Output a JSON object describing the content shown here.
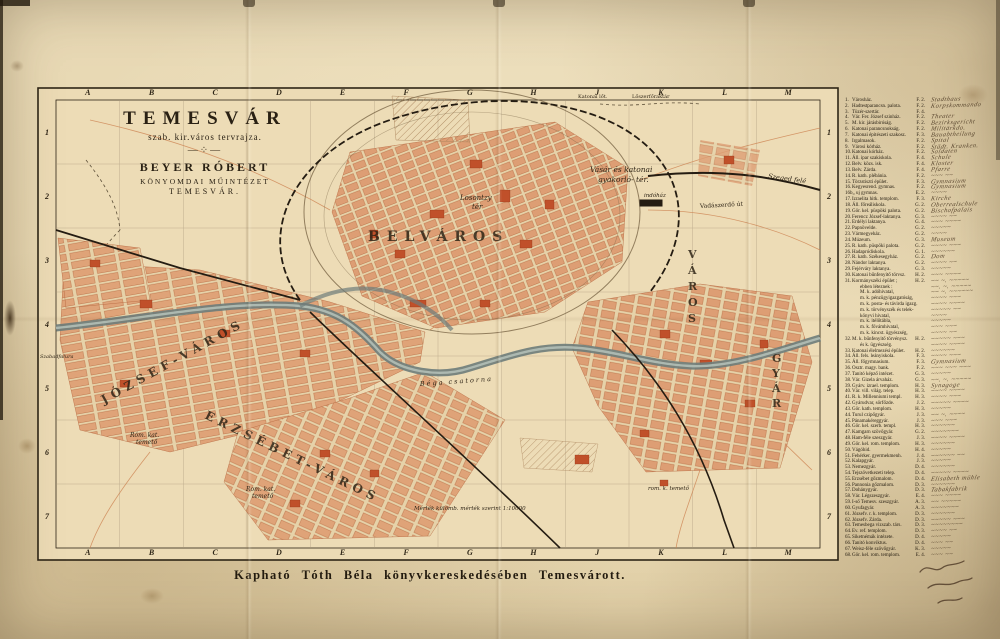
{
  "title_block": {
    "title": "TEMESVÁR",
    "subtitle": "szab. kir.város tervrajza.",
    "ornament": "—⁘—",
    "publisher": "BEYER RÓBERT",
    "publisher_line2": "KÖNYOMDAI MŰINTÉZET",
    "publisher_line3": "TEMESVÁR."
  },
  "caption": "Kapható Tóth Béla könyvkereskedésében Temesvárott.",
  "grid": {
    "columns": [
      "A",
      "B",
      "C",
      "D",
      "E",
      "F",
      "G",
      "H",
      "J",
      "K",
      "L",
      "M"
    ],
    "rows": [
      "1",
      "2",
      "3",
      "4",
      "5",
      "6",
      "7"
    ]
  },
  "palette": {
    "paper": "#e8d8b3",
    "block_salmon": "#dd9e74",
    "landmark_red": "#c0502a",
    "canal": "#6d7c7a",
    "ink": "#241c10",
    "handwriting": "#4d3a24"
  },
  "map": {
    "labels": {
      "belvaros": "BELVÁROS",
      "jozsefvaros": "JÓZSEF-VÁROS",
      "erzsebetvaros": "ERZSÉBET-VÁROS",
      "gyar": "GYÁR",
      "varos": "VÁROS",
      "losontzy": "Losontzy",
      "losontzy2": "tér",
      "vasar1": "Vásár és katonai",
      "vasar2": "gyakorló- tér.",
      "vadaszerdo_ut": "Vadászerdő út",
      "szeged": "Szeged felé",
      "indohaz": "indóház",
      "katonai_lot": "Katonai lőt.",
      "loszer": "Lőszerfőraktár",
      "romkat1a": "Róm. kat.",
      "romkat1b": "temető",
      "romkat2a": "Rom. kat.",
      "romkat2b": "temető",
      "romkat3": "rom. k. temető",
      "bega": "Béga csatorna",
      "mertek": "Mérték külömb. mérték szerint 1:10000",
      "szabadfalu": "Szabadfalura"
    }
  },
  "legend": {
    "items": [
      {
        "n": "1.",
        "label": "Városház.",
        "code": "F. 2.",
        "note": "Stadthaus"
      },
      {
        "n": "2.",
        "label": "Hadtestparancsn. palota.",
        "code": "F. 2.",
        "note": "Korpskommando"
      },
      {
        "n": "3.",
        "label": "Tüzér-szertár.",
        "code": "F. 4.",
        "note": ""
      },
      {
        "n": "4.",
        "label": "Vár. Fer. József szinház.",
        "code": "F. 2.",
        "note": "Theater"
      },
      {
        "n": "5.",
        "label": "M. kir. járásbiróság.",
        "code": "F. 2.",
        "note": "Bezirksgericht"
      },
      {
        "n": "6.",
        "label": "Katonai parancsnokság.",
        "code": "F. 2.",
        "note": "Militärkdo."
      },
      {
        "n": "7.",
        "label": "Katonai épitészeti szakosz.",
        "code": "F. 3.",
        "note": "Bauabtheilung"
      },
      {
        "n": "8.",
        "label": "Irgalmasok.",
        "code": "F. 2.",
        "note": "Spital"
      },
      {
        "n": "9.",
        "label": "Városi kórház.",
        "code": "F. 2.",
        "note": "Städt. Kranken."
      },
      {
        "n": "10.",
        "label": "Katonai kórház.",
        "code": "F. 2.",
        "note": "Soldaten"
      },
      {
        "n": "11.",
        "label": "Áll. ipar szakiskola.",
        "code": "F. 4.",
        "note": "Schule"
      },
      {
        "n": "12.",
        "label": "Belv. közs. isk.",
        "code": "F. 4.",
        "note": "Kloster"
      },
      {
        "n": "13.",
        "label": "Belv. Zárda.",
        "code": "F. 4.",
        "note": "Pfarre"
      },
      {
        "n": "14.",
        "label": "R. kath. plébánia.",
        "code": "F. 2.",
        "note": "~~~ ~~"
      },
      {
        "n": "15.",
        "label": "Törzstiszti épület.",
        "code": "F. 3.",
        "note": "Gymnasium"
      },
      {
        "n": "16.",
        "label": "Kegyesrend. gymnas.",
        "code": "F. 2.",
        "note": "Gymnasium"
      },
      {
        "n": "16b",
        "label": "„  uj gymnas.",
        "code": "E. 2.",
        "note": "~~~~"
      },
      {
        "n": "17.",
        "label": "Izraelita hitk. templom.",
        "code": "F. 3.",
        "note": "Kirche"
      },
      {
        "n": "18.",
        "label": "Áll. főreáliskola.",
        "code": "G. 2.",
        "note": "Oberrealschule"
      },
      {
        "n": "19.",
        "label": "Gör. kel. püspöki palota.",
        "code": "G. 2.",
        "note": "Bischofpalais"
      },
      {
        "n": "20.",
        "label": "Ferencz József-laktanya.",
        "code": "G. 3.",
        "note": "~~~~ ~~"
      },
      {
        "n": "21.",
        "label": "Erdélyi laktanya.",
        "code": "G. 4.",
        "note": "~~~ ~~~~"
      },
      {
        "n": "22.",
        "label": "Papnövelde.",
        "code": "G. 2.",
        "note": "~~~~~"
      },
      {
        "n": "23.",
        "label": "Vármegyeház.",
        "code": "G. 2.",
        "note": "~~~~"
      },
      {
        "n": "24.",
        "label": "Múzeum.",
        "code": "G. 3.",
        "note": "Museum"
      },
      {
        "n": "25.",
        "label": "R. kath. püspöki palota.",
        "code": "G. 2.",
        "note": "~~~~ ~~~"
      },
      {
        "n": "26.",
        "label": "Hadapródiskola.",
        "code": "G. 1.",
        "note": "~~~~~~"
      },
      {
        "n": "27.",
        "label": "R. kath. Székesegyház.",
        "code": "G. 2.",
        "note": "Dom"
      },
      {
        "n": "28.",
        "label": "Nándor laktanya.",
        "code": "G. 2.",
        "note": "~~~~ ~~"
      },
      {
        "n": "29.",
        "label": "Fejérváry laktanya.",
        "code": "G. 3.",
        "note": "~~~~~"
      },
      {
        "n": "30.",
        "label": "Katonai bűnfenyitő törvsz.",
        "code": "H. 2.",
        "note": "~~~ ~~~~"
      },
      {
        "n": "31.",
        "label": "Kormányszéki épület ;",
        "code": "H. 2.",
        "note": "~~ ~. ~~~~~"
      },
      {
        "n": "",
        "label": "ebben léteznek :",
        "code": "",
        "ind": true,
        "note": "~~. ~. ~~~~~"
      },
      {
        "n": "",
        "label": "M. k. adóhivatal,",
        "code": "",
        "ind": true,
        "note": "~~ ~. ~~~~~~"
      },
      {
        "n": "",
        "label": "m. k. pénzügyigazgatóság,",
        "code": "",
        "ind": true,
        "note": "~~~~ ~~~"
      },
      {
        "n": "",
        "label": "m. k. posta- és távirda igazg.",
        "code": "",
        "ind": true,
        "note": "~~~~ ~~~~"
      },
      {
        "n": "",
        "label": "m. k. törvényszék és telek-",
        "code": "",
        "ind": true,
        "note": "~~~~~ ~~"
      },
      {
        "n": "",
        "label": "könyvi hivatal,",
        "code": "",
        "ind": true,
        "note": "~~~~"
      },
      {
        "n": "",
        "label": "m. k. itélőtábla,",
        "code": "",
        "ind": true,
        "note": "~~~~~"
      },
      {
        "n": "",
        "label": "m. k. fővámhivatal,",
        "code": "",
        "ind": true,
        "note": "~~~ ~~~"
      },
      {
        "n": "",
        "label": "m. k. kincst. ügyészség,",
        "code": "",
        "ind": true,
        "note": "~~~~ ~~"
      },
      {
        "n": "32.",
        "label": "M. k. bűnfenyitő törvénysz.",
        "code": "H. 2.",
        "note": "~~~~~ ~~~"
      },
      {
        "n": "",
        "label": "és k. ügyészség.",
        "code": "",
        "ind": true,
        "note": "~~~~ ~~~~"
      },
      {
        "n": "33.",
        "label": "Katonai élelmezési épület.",
        "code": "H. 2.",
        "note": "~~~~~~"
      },
      {
        "n": "34.",
        "label": "Áll. fels. leányiskola.",
        "code": "F. 3.",
        "note": "~~~~ ~~~"
      },
      {
        "n": "35.",
        "label": "Áll. főgymnasium.",
        "code": "F. 3.",
        "note": "Gymnasium"
      },
      {
        "n": "36.",
        "label": "Osztr. magy. bank.",
        "code": "F. 2.",
        "note": "~~~ ~~~ ~~~"
      },
      {
        "n": "37.",
        "label": "Tanitó képző intézet.",
        "code": "G. 3.",
        "note": "~~~~~"
      },
      {
        "n": "38.",
        "label": "Vár. Gizela árvaház.",
        "code": "G. 3.",
        "note": "~~. ~. ~~~~~"
      },
      {
        "n": "39.",
        "label": "Gyárv. izrael. templom.",
        "code": "H. 3.",
        "note": "Synagoge"
      },
      {
        "n": "40.",
        "label": "Vár. vill. világ. telep.",
        "code": "H. 3.",
        "note": "~~~~ ~~~~"
      },
      {
        "n": "41.",
        "label": "R. k. Millenniumi templ.",
        "code": "H. 3.",
        "note": "~~~~ ~~~"
      },
      {
        "n": "42.",
        "label": "Gyárudvar, sörfőzde.",
        "code": "J. 2.",
        "note": "~~~~~ ~~~~"
      },
      {
        "n": "43.",
        "label": "Gör. kath. templom.",
        "code": "H. 3.",
        "note": "~~~~~"
      },
      {
        "n": "44.",
        "label": "Turul czipőgyár.",
        "code": "J. 3.",
        "note": "~~ ~. ~~~~"
      },
      {
        "n": "45.",
        "label": "Pánamakéreggyár.",
        "code": "J. 3.",
        "note": "~~~ ~~~"
      },
      {
        "n": "46.",
        "label": "Gör. kel. szerb. templ.",
        "code": "H. 3.",
        "note": "~~~~~~"
      },
      {
        "n": "47.",
        "label": "Kamgarn szövőgyár.",
        "code": "G. 2.",
        "note": "~~~~~~~"
      },
      {
        "n": "48.",
        "label": "Ham-féle szeszgyár.",
        "code": "J. 3.",
        "note": "~~~~ ~~~~"
      },
      {
        "n": "49.",
        "label": "Gör. kel. rom. templom.",
        "code": "H. 3.",
        "note": "~~~~~~"
      },
      {
        "n": "50.",
        "label": "Vágóhid.",
        "code": "H. 4.",
        "note": "~~~~~"
      },
      {
        "n": "51.",
        "label": "Fehérker. gyermekmenh.",
        "code": "J. 4.",
        "note": "~~~~~~ ~~"
      },
      {
        "n": "52.",
        "label": "Kalapgyár.",
        "code": "J. 3.",
        "note": "~~~~~"
      },
      {
        "n": "53.",
        "label": "Nemezgyár.",
        "code": "D. 4.",
        "note": "~~~~~~"
      },
      {
        "n": "54.",
        "label": "Tejszövetkezeti telep.",
        "code": "D. 4.",
        "note": "~~~~~ ~~~~"
      },
      {
        "n": "55.",
        "label": "Erzsébet gőzmalom.",
        "code": "D. 4.",
        "note": "Elisabeth mühle"
      },
      {
        "n": "56.",
        "label": "Pannonia gőzmalom.",
        "code": "D. 3.",
        "note": "~~~~~~"
      },
      {
        "n": "57.",
        "label": "Dohánygyár.",
        "code": "D. 3.",
        "note": "Tabakfabrik"
      },
      {
        "n": "58.",
        "label": "Vár. Légszeszgyár.",
        "code": "E. 4.",
        "note": "~~~ ~~~~"
      },
      {
        "n": "59.",
        "label": "I-ső Temesv. szeszgyár.",
        "code": "A. 3.",
        "note": "~~ ~~~~~"
      },
      {
        "n": "60.",
        "label": "Gyufagyár.",
        "code": "A. 3.",
        "note": "~~~~~~~"
      },
      {
        "n": "61.",
        "label": "Józsefv. r. k. templom.",
        "code": "D. 3.",
        "note": "~~~~~~"
      },
      {
        "n": "62.",
        "label": "Józsefv. Zárda.",
        "code": "D. 3.",
        "note": "~~~~~ ~~~"
      },
      {
        "n": "63.",
        "label": "Temesbega vizszab. társ.",
        "code": "D. 3.",
        "note": "~~~~~~~~"
      },
      {
        "n": "64.",
        "label": "Ev. ref. templom.",
        "code": "D. 3.",
        "note": "~~~~ ~~"
      },
      {
        "n": "65.",
        "label": "Siketnémák intézete.",
        "code": "D. 4.",
        "note": "~~~~~"
      },
      {
        "n": "66.",
        "label": "Tanitó konviktus.",
        "code": "D. 4.",
        "note": "~~~ ~~"
      },
      {
        "n": "67.",
        "label": "Weisz-féle szövőgyár.",
        "code": "K. 3.",
        "note": "~~~~~"
      },
      {
        "n": "68.",
        "label": "Gör. kel. rom. templom.",
        "code": "E. 4.",
        "note": "~~~ ~~"
      }
    ]
  }
}
